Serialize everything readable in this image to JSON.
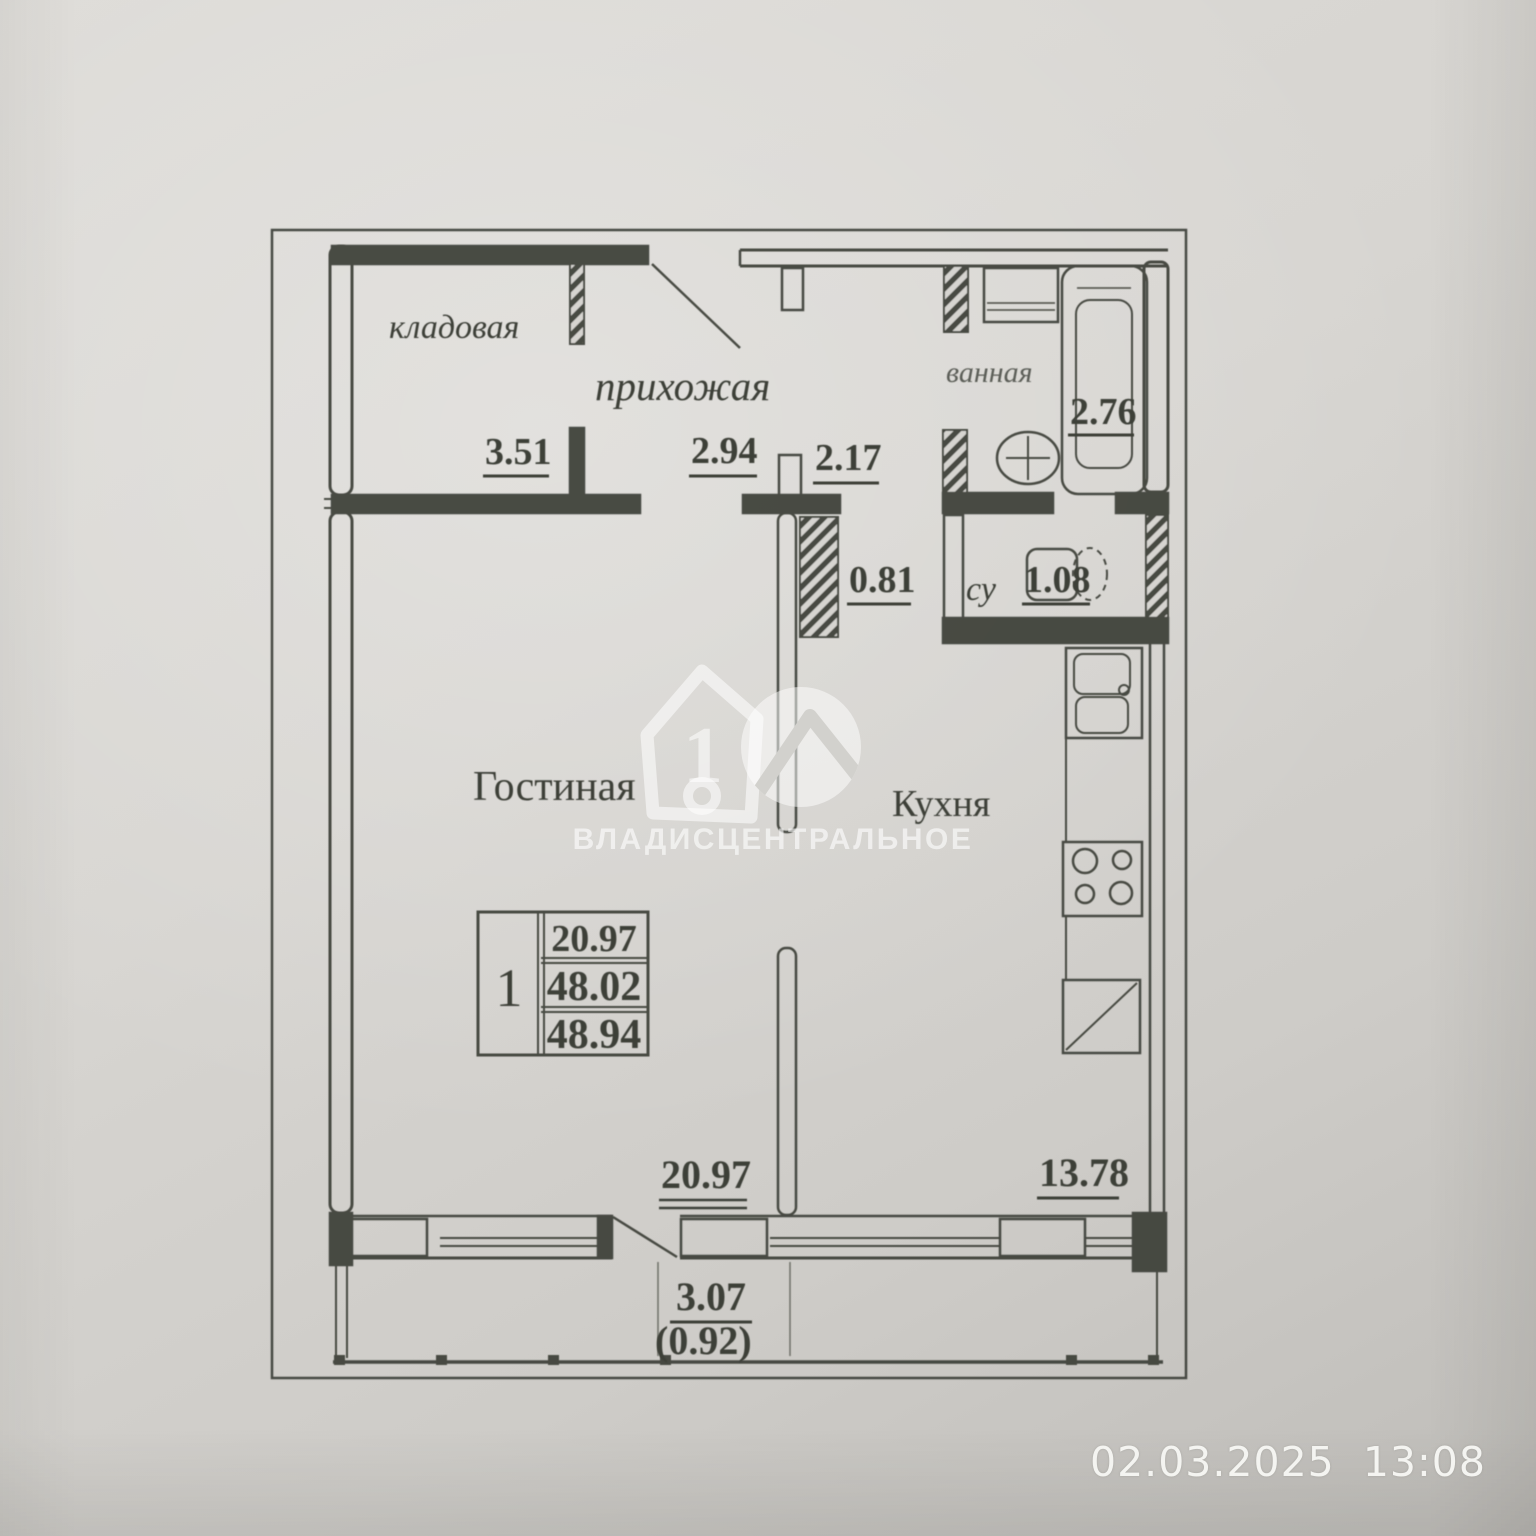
{
  "photo": {
    "timestamp": "02.03.2025  13:08"
  },
  "watermark": {
    "logo_number": "1",
    "company": "ВЛАДИСЦЕНТРАЛЬНОЕ"
  },
  "plan": {
    "rooms": {
      "storage": "кладовая",
      "hallway": "прихожая",
      "bathroom": "ванная",
      "wc": "су",
      "living": "Гостиная",
      "kitchen": "Кухня"
    },
    "dims": {
      "storage": "3.51",
      "hallway_left": "2.94",
      "hallway_right": "2.17",
      "bathroom": "2.76",
      "corridor": "0.81",
      "wc": "1.08",
      "living": "20.97",
      "kitchen": "13.78",
      "balcony": "3.07",
      "balcony_reduced": "(0.92)"
    },
    "info_table": {
      "rooms_count": "1",
      "living_area": "20.97",
      "area": "48.02",
      "total_area": "48.94"
    }
  },
  "colors": {
    "ink": "#3c3f38",
    "paper": "#d6d4d0",
    "watermark": "#ffffff",
    "timestamp_text": "#f4f4f1"
  }
}
